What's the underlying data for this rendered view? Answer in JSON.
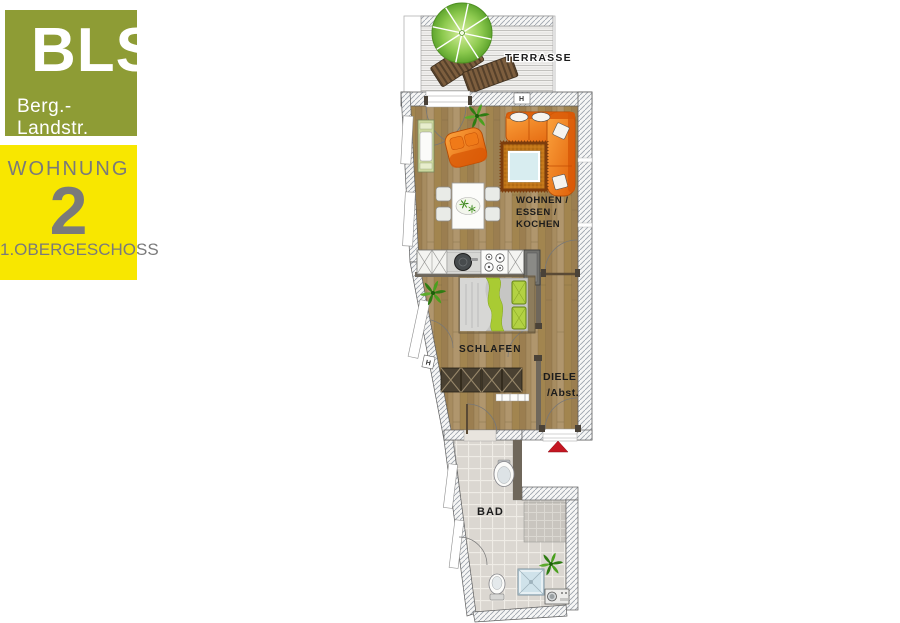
{
  "branding": {
    "logo_title": "BLS",
    "logo_subtitle": "Berg.-Landstr.",
    "logo_bg_color": "#8e9c35"
  },
  "unit_badge": {
    "line1": "WOHNUNG",
    "number": "2",
    "line2": "1.OBERGESCHOSS",
    "bg_color": "#f8e700",
    "text_color": "#7a7a7a"
  },
  "floorplan": {
    "rooms": {
      "terrace": {
        "label": "TERRASSE"
      },
      "living": {
        "line1": "WOHNEN /",
        "line2": "ESSEN /",
        "line3": "KOCHEN"
      },
      "bedroom": {
        "label": "SCHLAFEN"
      },
      "hall": {
        "line1": "DIELE",
        "line2": "/Abst."
      },
      "bath": {
        "label": "BAD"
      }
    },
    "markers": {
      "window_marker": "H"
    },
    "colors": {
      "wood_floor": "#a78c60",
      "bath_tile": "#dbd7d1",
      "sofa_orange": "#ee7512",
      "entry_arrow_red": "#c41622",
      "parasol_green": "#8cc94e"
    }
  }
}
